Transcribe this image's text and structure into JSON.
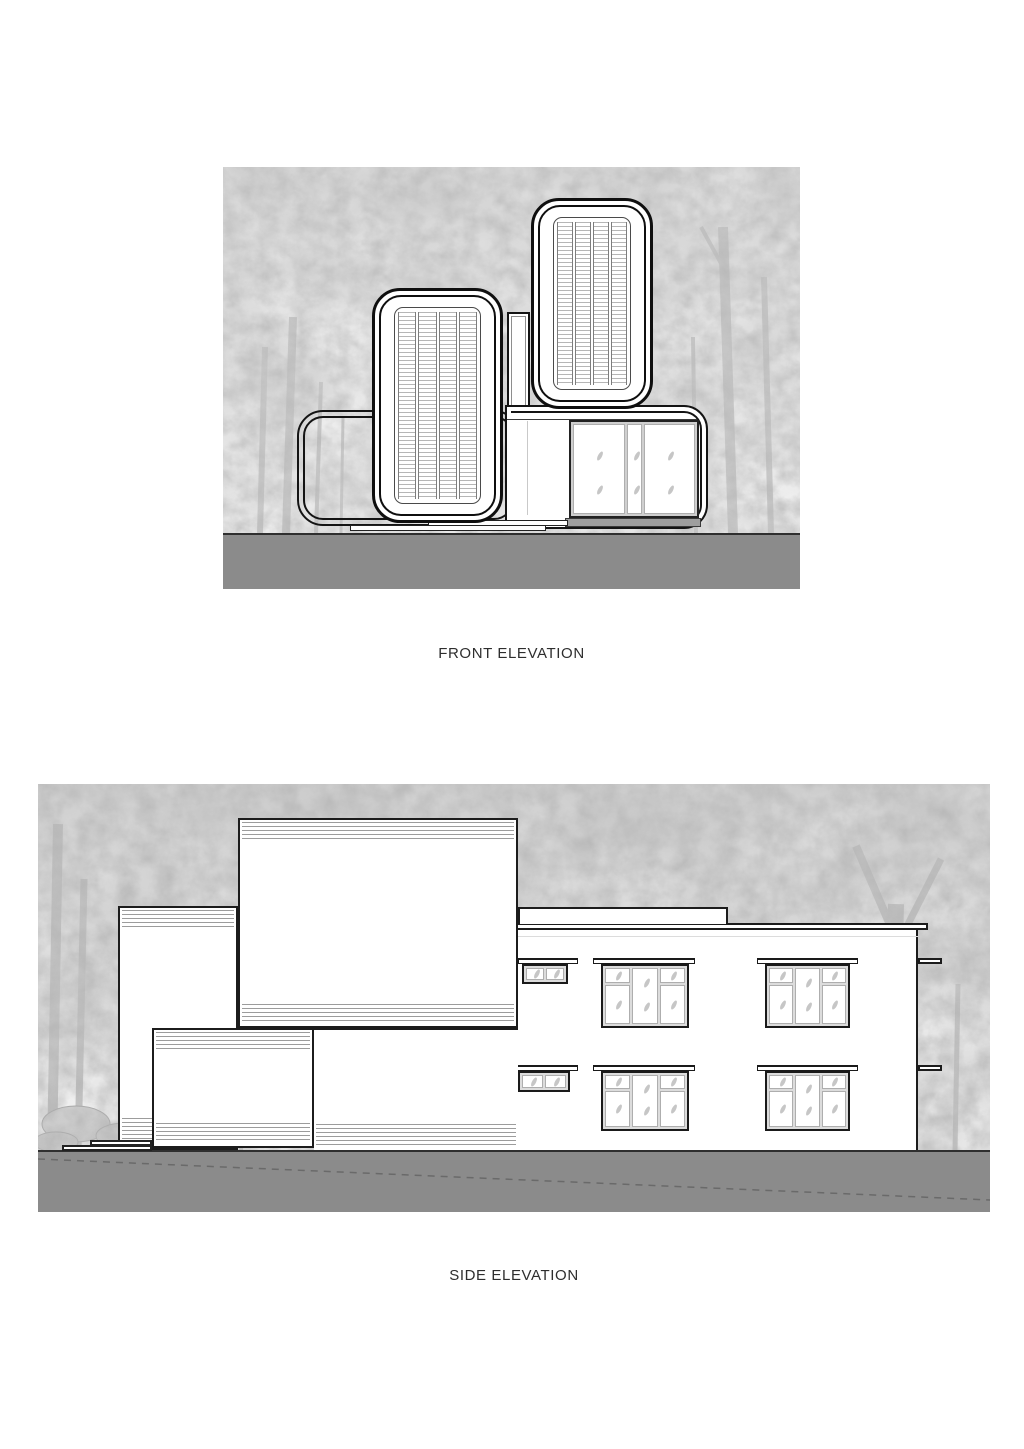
{
  "labels": {
    "front": "FRONT ELEVATION",
    "side": "SIDE ELEVATION"
  },
  "colors": {
    "page_background": "#ffffff",
    "ground": "#8b8b8b",
    "linework": "#141414",
    "foliage_gray": "#b0b0b0",
    "trunk_gray": "#c3c3c3",
    "louver_slat": "#b6b6b6",
    "window_frame_fill": "#dcdcdc",
    "pane_border": "#aeaeae",
    "leaf_mark": "#c6c6c6",
    "hatch_line": "#9c9c9c",
    "glass_base_strip": "#9e9e9e",
    "grade_dash_line": "#6a6a6a"
  },
  "front_elevation": {
    "modules": [
      "open frame module",
      "left louver module",
      "right louver module",
      "glazed module"
    ],
    "louver_columns_per_module": 4,
    "glazed_pane_count": 3
  },
  "side_elevation": {
    "upper_window_count": 3,
    "lower_window_count": 5,
    "building_boxes": [
      "back left box",
      "large upper box",
      "lower left box",
      "main two-storey block"
    ]
  }
}
